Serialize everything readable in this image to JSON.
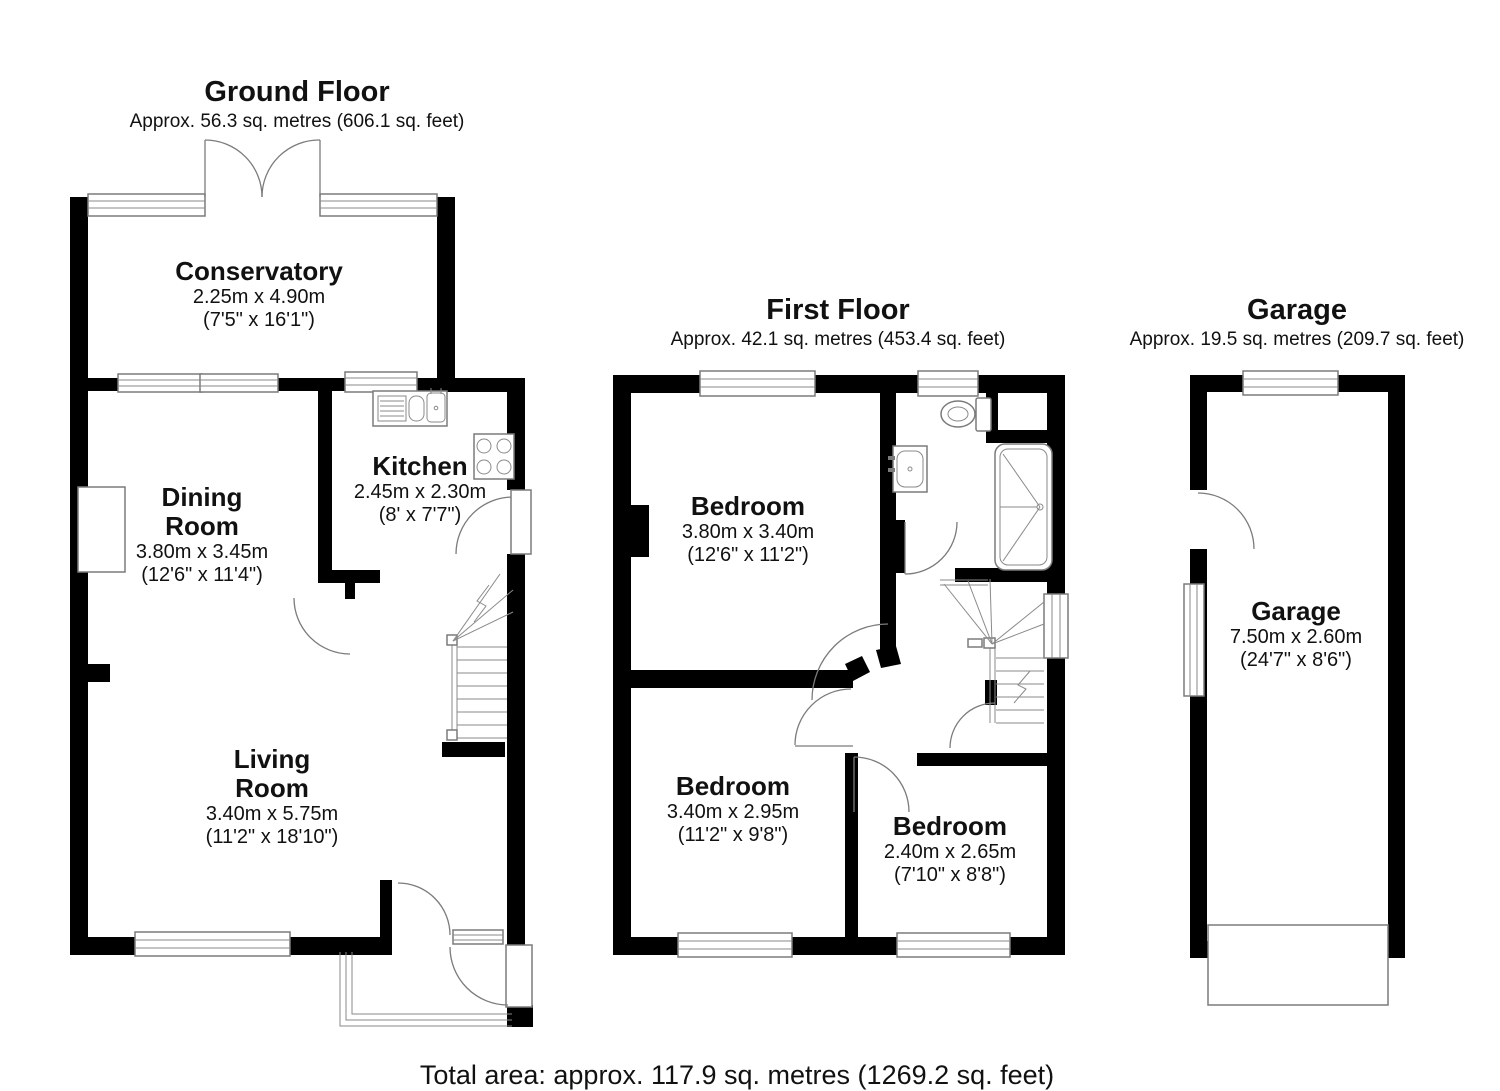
{
  "plan": {
    "ground_floor": {
      "title": "Ground Floor",
      "subtitle": "Approx. 56.3 sq. metres (606.1 sq. feet)",
      "rooms": {
        "conservatory": {
          "name": "Conservatory",
          "metric": "2.25m x 4.90m",
          "imperial": "(7'5\" x 16'1\")"
        },
        "dining_room": {
          "name_line1": "Dining",
          "name_line2": "Room",
          "metric": "3.80m x 3.45m",
          "imperial": "(12'6\" x 11'4\")"
        },
        "kitchen": {
          "name": "Kitchen",
          "metric": "2.45m x 2.30m",
          "imperial": "(8' x 7'7\")"
        },
        "living_room": {
          "name_line1": "Living",
          "name_line2": "Room",
          "metric": "3.40m x 5.75m",
          "imperial": "(11'2\" x 18'10\")"
        }
      }
    },
    "first_floor": {
      "title": "First Floor",
      "subtitle": "Approx. 42.1 sq. metres (453.4 sq. feet)",
      "rooms": {
        "bedroom1": {
          "name": "Bedroom",
          "metric": "3.80m x 3.40m",
          "imperial": "(12'6\" x 11'2\")"
        },
        "bedroom2": {
          "name": "Bedroom",
          "metric": "3.40m x 2.95m",
          "imperial": "(11'2\" x 9'8\")"
        },
        "bedroom3": {
          "name": "Bedroom",
          "metric": "2.40m x 2.65m",
          "imperial": "(7'10\" x 8'8\")"
        }
      }
    },
    "garage_block": {
      "title": "Garage",
      "subtitle": "Approx. 19.5 sq. metres (209.7 sq. feet)",
      "rooms": {
        "garage": {
          "name": "Garage",
          "metric": "7.50m x 2.60m",
          "imperial": "(24'7\" x 8'6\")"
        }
      }
    },
    "total": "Total area: approx. 117.9 sq. metres (1269.2 sq. feet)",
    "colors": {
      "wall": "#000000",
      "detail_line": "#7b7b7b",
      "text": "#111111",
      "background": "#ffffff"
    }
  }
}
